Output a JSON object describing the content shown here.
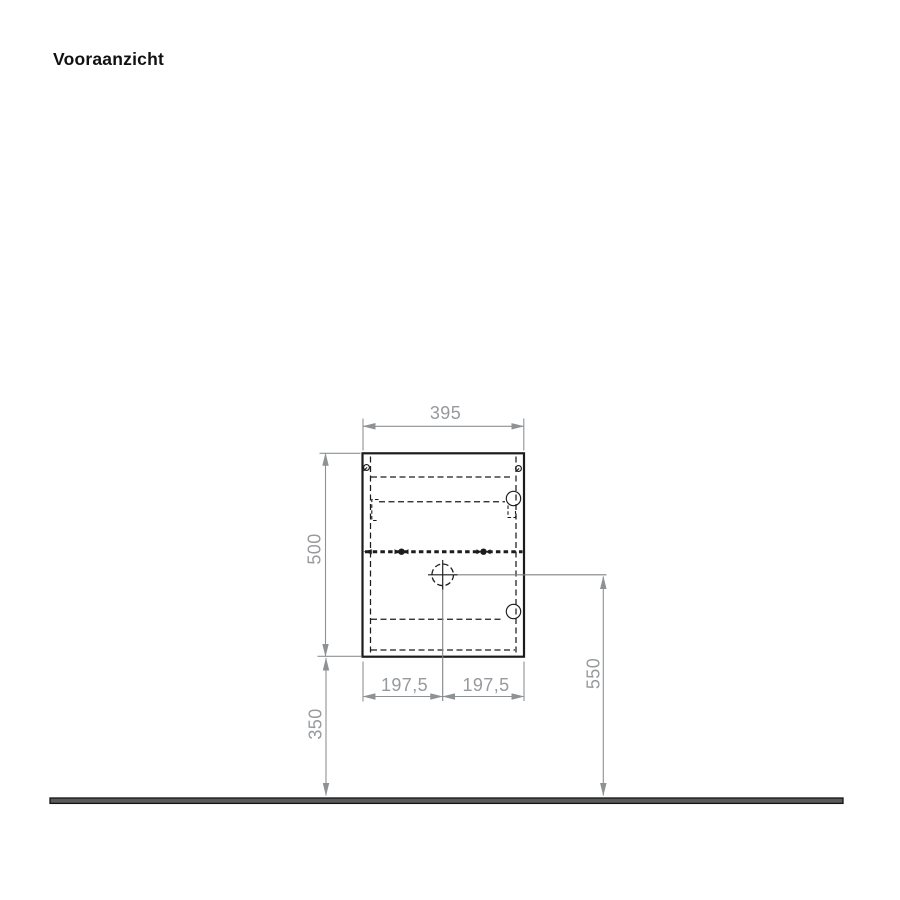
{
  "title": "Vooraanzicht",
  "dimensions": {
    "top_width": "395",
    "left_height": "500",
    "left_bottom_height": "350",
    "right_height": "550",
    "bottom_left_half": "197,5",
    "bottom_right_half": "197,5"
  },
  "colors": {
    "drawing_line": "#1c1c1c",
    "dimension_line": "#8e9294",
    "dimension_text": "#97999c",
    "floor_fill": "#5a5a5a",
    "background": "#ffffff"
  }
}
